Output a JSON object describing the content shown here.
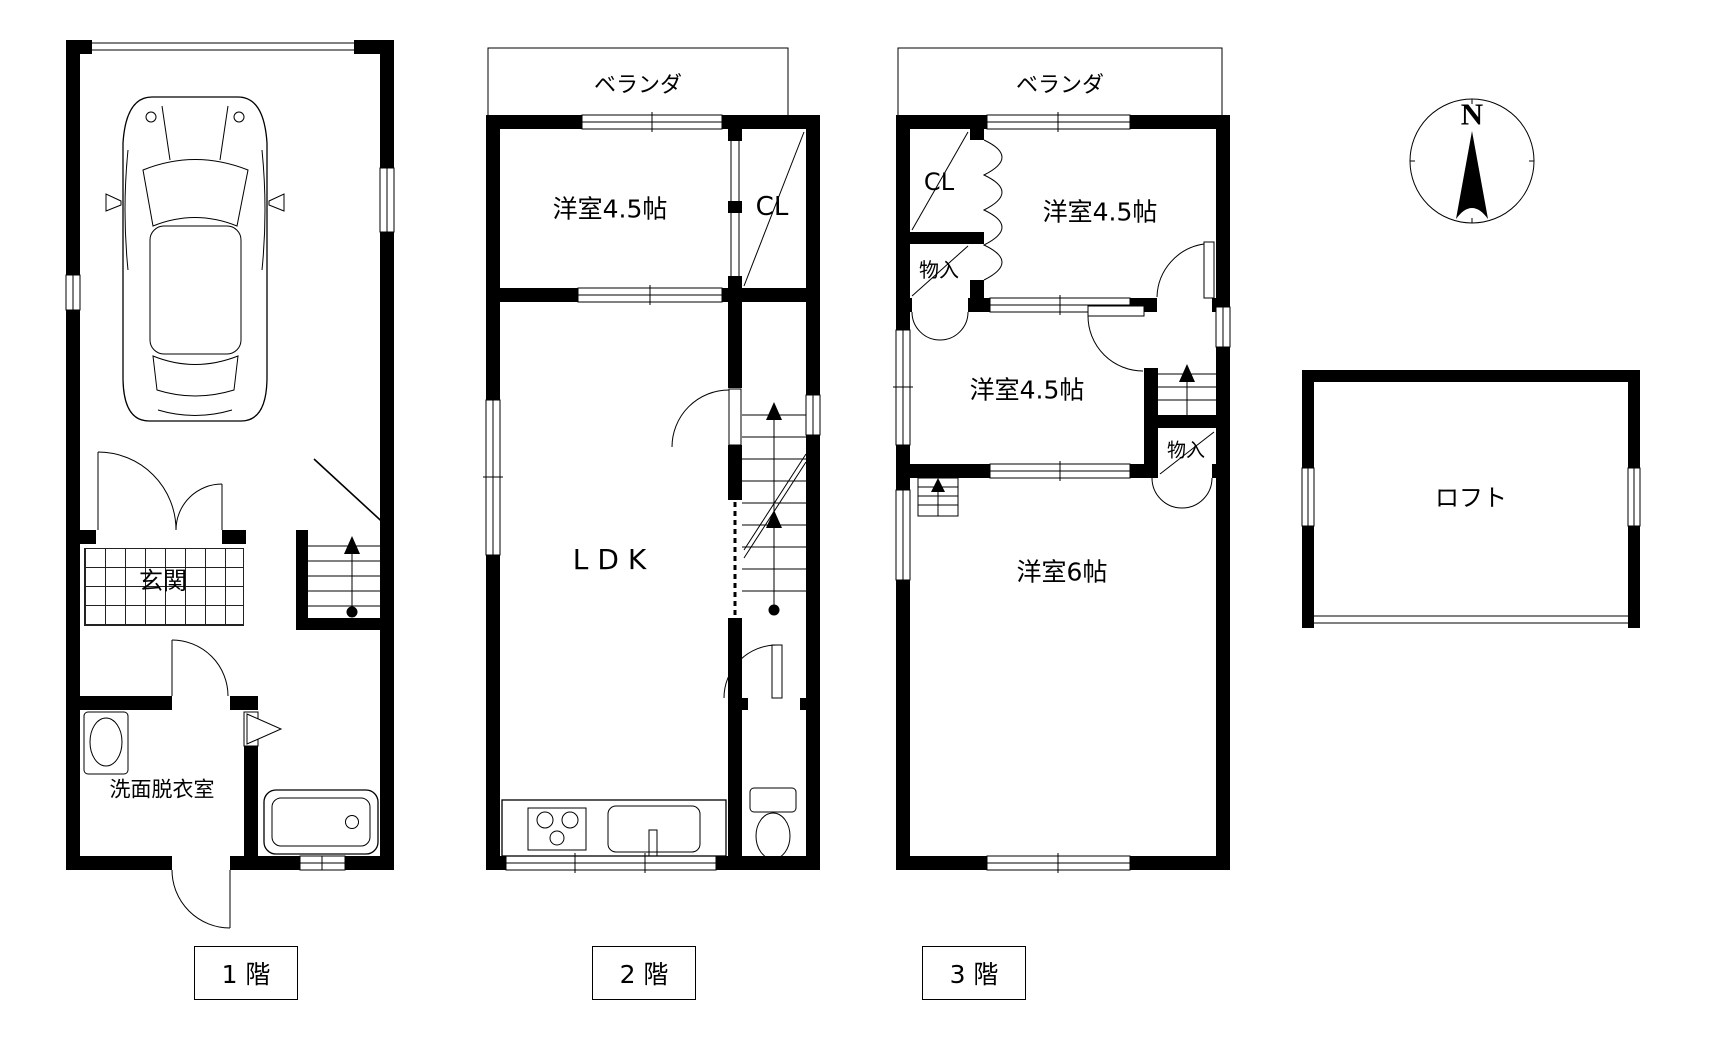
{
  "page": {
    "background": "#ffffff",
    "line_color": "#000000"
  },
  "compass": {
    "north_label": "N"
  },
  "floor1": {
    "label": "1 階",
    "entrance": "玄関",
    "washroom": "洗面脱衣室"
  },
  "floor2": {
    "label": "2 階",
    "veranda": "ベランダ",
    "western_room": "洋室4.5帖",
    "closet": "CL",
    "ldk": "LDK"
  },
  "floor3": {
    "label": "3 階",
    "veranda": "ベランダ",
    "closet": "CL",
    "storage_upper": "物入",
    "western_room_top": "洋室4.5帖",
    "western_room_mid": "洋室4.5帖",
    "storage_lower": "物入",
    "western_room_large": "洋室6帖"
  },
  "loft": {
    "label": "ロフト"
  }
}
